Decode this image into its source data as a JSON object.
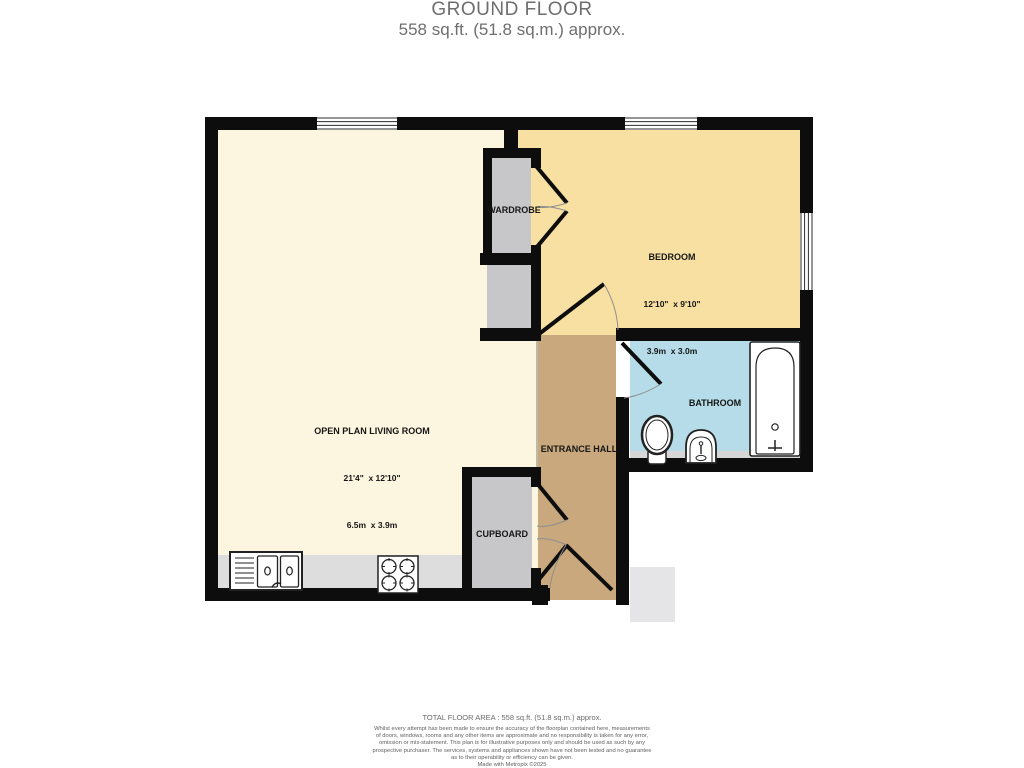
{
  "title": {
    "line1": "GROUND FLOOR",
    "line2": "558 sq.ft. (51.8 sq.m.) approx."
  },
  "rooms": {
    "living": {
      "name": "OPEN PLAN LIVING ROOM",
      "dims_imperial": "21'4\"  x 12'10\"",
      "dims_metric": "6.5m  x 3.9m"
    },
    "bedroom": {
      "name": "BEDROOM",
      "dims_imperial": "12'10\"  x 9'10\"",
      "dims_metric": "3.9m  x 3.0m"
    },
    "bathroom": {
      "name": "BATHROOM"
    },
    "entrance_hall": {
      "name": "ENTRANCE HALL"
    },
    "wardrobe": {
      "name": "WARDROBE"
    },
    "cupboard": {
      "name": "CUPBOARD"
    }
  },
  "footer": {
    "total_area": "TOTAL FLOOR AREA : 558 sq.ft. (51.8 sq.m.) approx.",
    "disclaimer_lines": [
      "Whilst every attempt has been made to ensure the accuracy of the floorplan contained here, measurements",
      "of doors, windows, rooms and any other items are approximate and no responsibility is taken for any error,",
      "omission or mis-statement. This plan is for illustrative purposes only and should be used as such by any",
      "prospective purchaser. The services, systems and appliances shown have not been tested and no guarantee",
      "as to their operability or efficiency can be given."
    ],
    "credit": "Made with Metropix ©2025"
  },
  "colors": {
    "wall": "#0d0d0d",
    "living_floor": "#fcf5df",
    "bedroom_floor": "#f8e0a2",
    "hall_floor": "#c9a87e",
    "bathroom_floor": "#b5dce8",
    "storage_floor": "#c7c6c8",
    "counter": "#dddddd",
    "bath_strip": "#d6d6d6",
    "outside_step": "#e5e5e7"
  }
}
